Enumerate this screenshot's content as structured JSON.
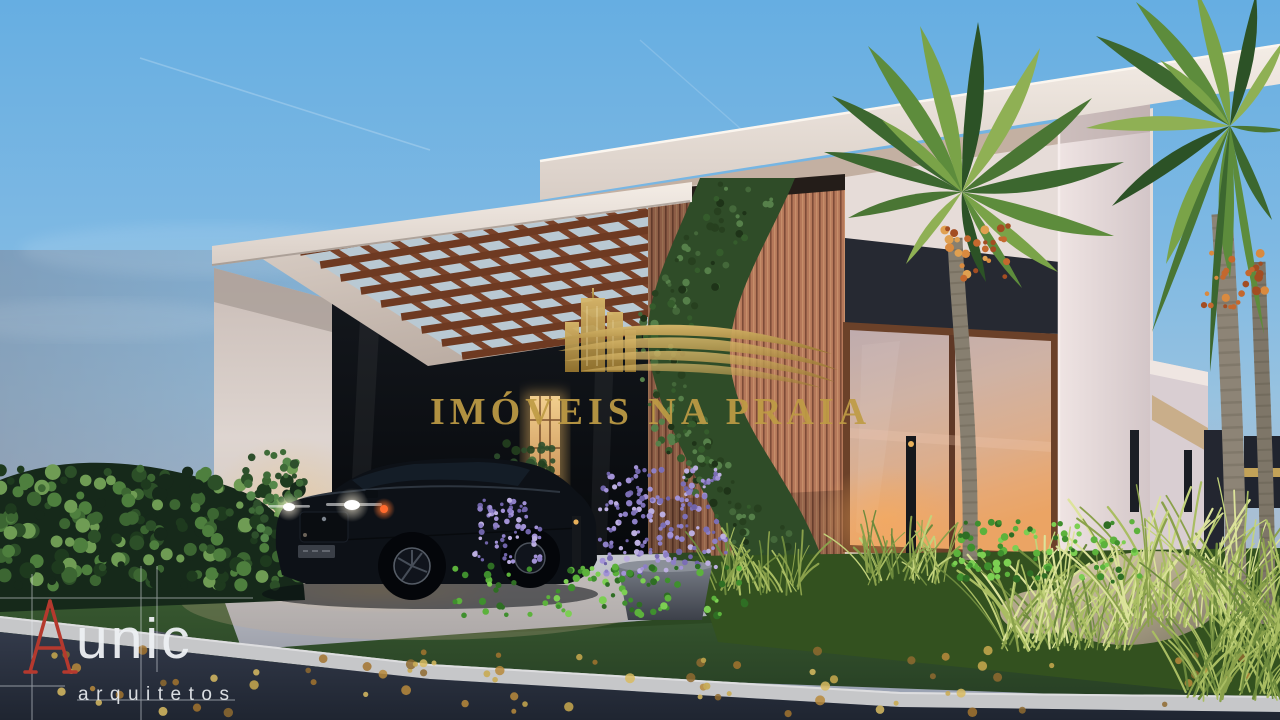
{
  "watermark": {
    "title": "IMÓVEIS NA PRAIA",
    "color": "#bf9c45",
    "logo": "buildings-and-waves"
  },
  "architect": {
    "brand": "unic",
    "subtitle": "arquitetos",
    "accent_color": "#b5392e",
    "text_color": "#eef1f4"
  },
  "palette": {
    "sky_top": "#66aee2",
    "sky_dusk": "#9aa2b2",
    "roof_white": "#efe8e1",
    "soffit": "#c3b0a2",
    "wood_slat": "#b5785a",
    "pergola_wood": "#7a432a",
    "ivy_green": "#2f4c28",
    "accent_navy": "#262932",
    "window_sunset": "#e8a868",
    "wall_white": "#e9dede",
    "lawn_green": "#33522c",
    "grass_yellow": "#a9bd62",
    "lavender": "#8d7fc6",
    "driveway": "#b9bcc5",
    "asphalt": "#2b3240",
    "curb": "#c6c7c9",
    "car_black": "#0d1117",
    "headlight": "#ffffff",
    "drl_orange": "#ff6a2e",
    "palm_green": "#4a7634",
    "palm_fruit": "#c4682e",
    "trunk_gray": "#877f70",
    "boulder": "#cfc2a4",
    "leaf_gold": "#c9a94e"
  }
}
